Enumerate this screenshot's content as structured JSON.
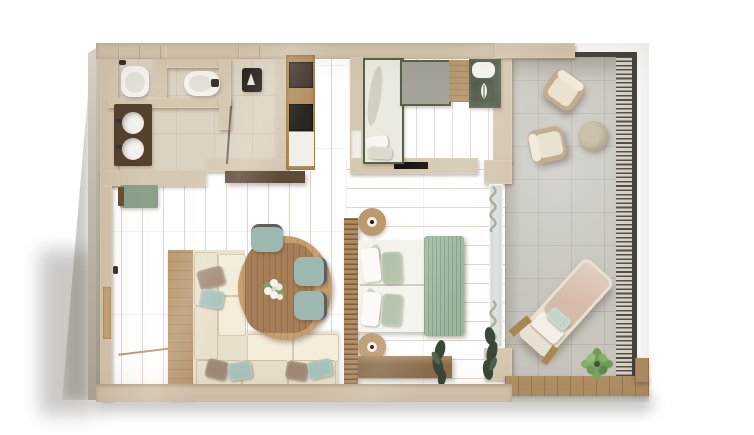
{
  "scene": {
    "type": "3d-floor-plan-render",
    "view": "top-down-cutaway",
    "rooms": [
      {
        "name": "bathroom",
        "floor": "beige-tile",
        "furniture": [
          "toilet",
          "bidet",
          "walk-in-shower-with-glass-door",
          "double-sink-vanity"
        ]
      },
      {
        "name": "entry-hall",
        "floor": "oak-planks",
        "furniture": [
          "entrance-door",
          "sage-bench"
        ]
      },
      {
        "name": "closet-nook",
        "floor": "oak-planks",
        "furniture": [
          "wardrobe-minibar-unit-with-dark-panels"
        ]
      },
      {
        "name": "living-dining",
        "floor": "oak-planks",
        "furniture": [
          "l-shaped-corner-sofa",
          "throw-pillows",
          "oval-wood-dining-table",
          "flower-centerpiece",
          "dining-chairs",
          "tv-console"
        ]
      },
      {
        "name": "kids-bedroom",
        "floor": "oak-planks",
        "furniture": [
          "single-daybed-white",
          "corner-daybed-green-frame",
          "gray-panel",
          "leaf-print-pillow",
          "wall-tv",
          "pocket-door"
        ]
      },
      {
        "name": "master-bedroom",
        "floor": "oak-planks",
        "furniture": [
          "double-bed-white-duvet",
          "sage-throw",
          "slatted-headboard-panel",
          "round-nightstand-top",
          "round-nightstand-bottom",
          "dresser",
          "floor-plant",
          "curtains",
          "glass-wall-to-terrace"
        ]
      },
      {
        "name": "terrace",
        "floor": "concrete-tiles",
        "furniture": [
          "armchair-1",
          "armchair-2",
          "round-pouf",
          "sun-lounger",
          "potted-plant",
          "louvered-privacy-screen",
          "wood-deck-border"
        ]
      }
    ]
  },
  "counts": {
    "dining_chairs": 3,
    "terrace_armchairs": 2,
    "sink_basins": 2,
    "beds": 3,
    "plants": 3
  },
  "palette": {
    "wall": "#d5c7b0",
    "tile": "#dbd2c1",
    "wood": "#cda87c",
    "wood_dark": "#b48a5c",
    "wood_light": "#e0bf95",
    "wood_b2": "#d7b388",
    "concrete": "#c8c5be",
    "deck": "#b29066",
    "louver": "#555048",
    "louver_bg": "#d8d5ce",
    "rail": "#46423c",
    "sofa_cream": "#e8e0ca",
    "sofa_white": "#f3edda",
    "sofa_base": "#efe8d4",
    "sofa_wood": "#b9976f",
    "pillow_taupe": "#a18977",
    "pillow_blue": "#a9c2bc",
    "table_wood": "#c59e72",
    "table_top": "#a67f58",
    "chair_teal": "#9db8b1",
    "chair_frame": "#5d5f58",
    "bed_white": "#f4f2eb",
    "pillow_sage": "#adbfa5",
    "throw_sage": "#9cb69e",
    "headboard": "#b08a61",
    "nightstand": "#bf9d72",
    "dresser": "#8b6d4c",
    "tv_console": "#5e4b37",
    "closet_wood": "#b5905f",
    "panel_dark": "#443931",
    "panel_black": "#282420",
    "panel_white": "#f2efe8",
    "bench_sage": "#8b9f8a",
    "unit_green": "#55614b",
    "unit_gray": "#a3a198",
    "unit_tan": "#b5976c",
    "unit_bedgreen": "#4d5943",
    "terrace_chair": "#e9e2d1",
    "chair_tan": "#c3ad8e",
    "pouf": "#cbc1ac",
    "lounger": "#d5bbaa",
    "lounger_base": "#e8e0d0",
    "mint": "#c4d4cb",
    "plant": "#7aa45f",
    "plant_dark": "#44523e",
    "fixture": "#f4f2ed",
    "vanity": "#54422e",
    "glass": "#dfe3de",
    "curtain": "#b2b5ad"
  }
}
